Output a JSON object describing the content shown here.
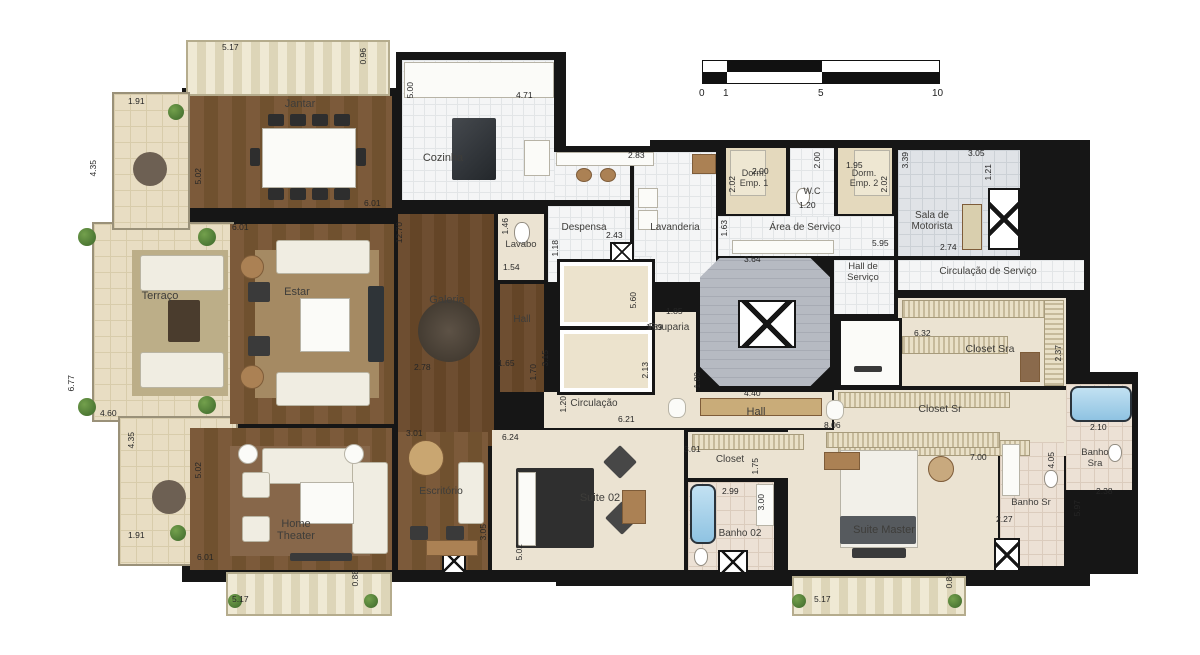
{
  "colors": {
    "wall": "#161616",
    "wood_floor": "#7c5a3a",
    "tile_floor": "#f4f5f6",
    "carpet_floor": "#ebe3d2",
    "terrace_floor": "#e8ddc3",
    "bath_tile": "#ece1d5",
    "bathtub": "#8fc3e2"
  },
  "scale_bar": {
    "ticks": [
      "0",
      "1",
      "5",
      "10"
    ]
  },
  "rooms": {
    "jantar": "Jantar",
    "cozinha": "Cozinha",
    "terraco": "Terraço",
    "estar": "Estar",
    "galeria": "Galeria",
    "lavabo": "Lavabo",
    "despensa": "Despensa",
    "lavanderia": "Lavanderia",
    "dorm_emp_1": "Dorm. Emp. 1",
    "wc": "W.C",
    "dorm_emp_2": "Dorm. Emp. 2",
    "sala_motorista": "Sala de Motorista",
    "area_servico": "Área de Serviço",
    "hall_servico": "Hall de Serviço",
    "circulacao_servico": "Circulação de Serviço",
    "rouparia": "Rouparia",
    "hall_elevadores": "Hall",
    "circulacao": "Circulação",
    "hall_intimo": "Hall",
    "closet_sra": "Closet Sra",
    "closet_sr": "Closet Sr",
    "banho_sra": "Banho Sra",
    "banho_sr": "Banho Sr",
    "home_theater": "Home Theater",
    "escritorio": "Escritório",
    "suite_02": "Suite 02",
    "closet_suite02": "Closet",
    "banho_02": "Banho 02",
    "suite_master": "Suite Master"
  },
  "dims": [
    "5.17",
    "0.96",
    "5.02",
    "5.00",
    "4.71",
    "6.01",
    "2.83",
    "2.00",
    "2.02",
    "2.00",
    "1.20",
    "1.95",
    "2.02",
    "3.39",
    "3.05",
    "1.21",
    "2.74",
    "5.95",
    "1.63",
    "2.43",
    "1.18",
    "1.46",
    "1.54",
    "12.70",
    "6.01",
    "1.91",
    "4.35",
    "6.77",
    "4.60",
    "4.35",
    "1.91",
    "2.78",
    "1.65",
    "3.15",
    "1.70",
    "5.60",
    "1.85",
    "1.89",
    "2.13",
    "3.64",
    "1.80",
    "4.40",
    "6.21",
    "8.06",
    "6.32",
    "2.37",
    "2.10",
    "7.00",
    "4.05",
    "2.27",
    "2.38",
    "5.97",
    "1.20",
    "6.24",
    "3.01",
    "3.05",
    "5.02",
    "5.02",
    "6.01",
    "0.88",
    "5.17",
    "3.01",
    "1.75",
    "2.99",
    "3.00",
    "0.86",
    "5.17"
  ]
}
